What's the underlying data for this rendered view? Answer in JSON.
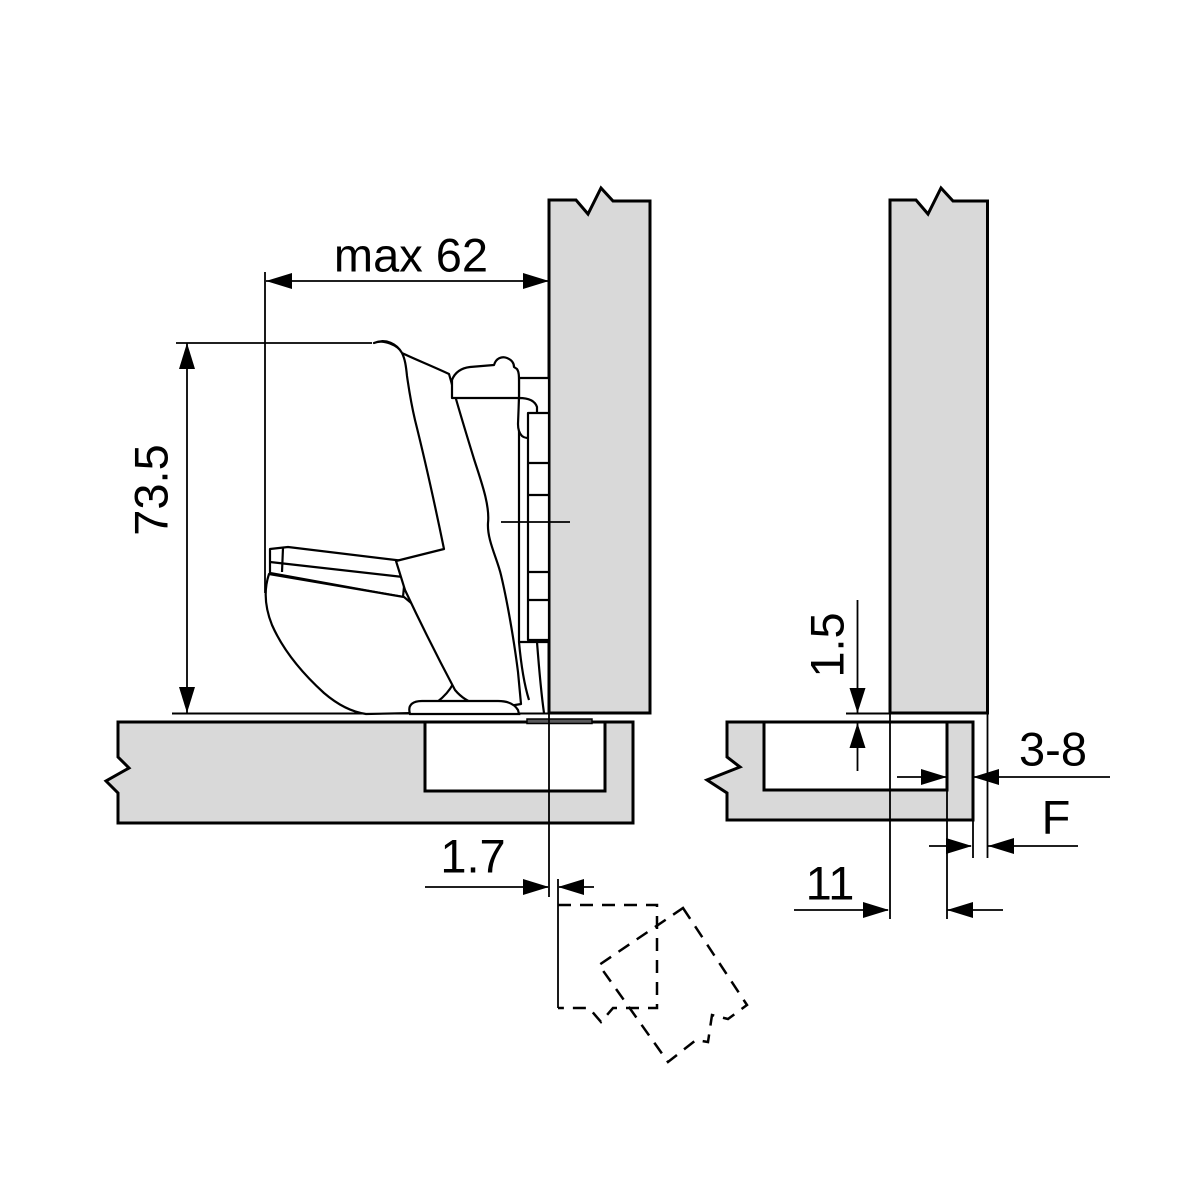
{
  "figure": {
    "type": "technical-drawing",
    "description": "Hinge mounting application cross-section with two views: side view of opened hinge on door/cabinet panels and detail view of panel reveal",
    "colors": {
      "background": "#ffffff",
      "panel_fill": "#d9d9d9",
      "hinge_bar_fill": "#58585a",
      "line": "#000000"
    },
    "views": {
      "left": {
        "name": "hinge-side-view",
        "dimensions": {
          "max_width": "max 62",
          "hinge_height": "73.5",
          "front_gap": "1.7"
        }
      },
      "right": {
        "name": "panel-detail-view",
        "dimensions": {
          "top_clearance": "1.5",
          "false_bottom_range": "3-8",
          "reveal": "F",
          "mount_distance": "11"
        }
      }
    }
  }
}
